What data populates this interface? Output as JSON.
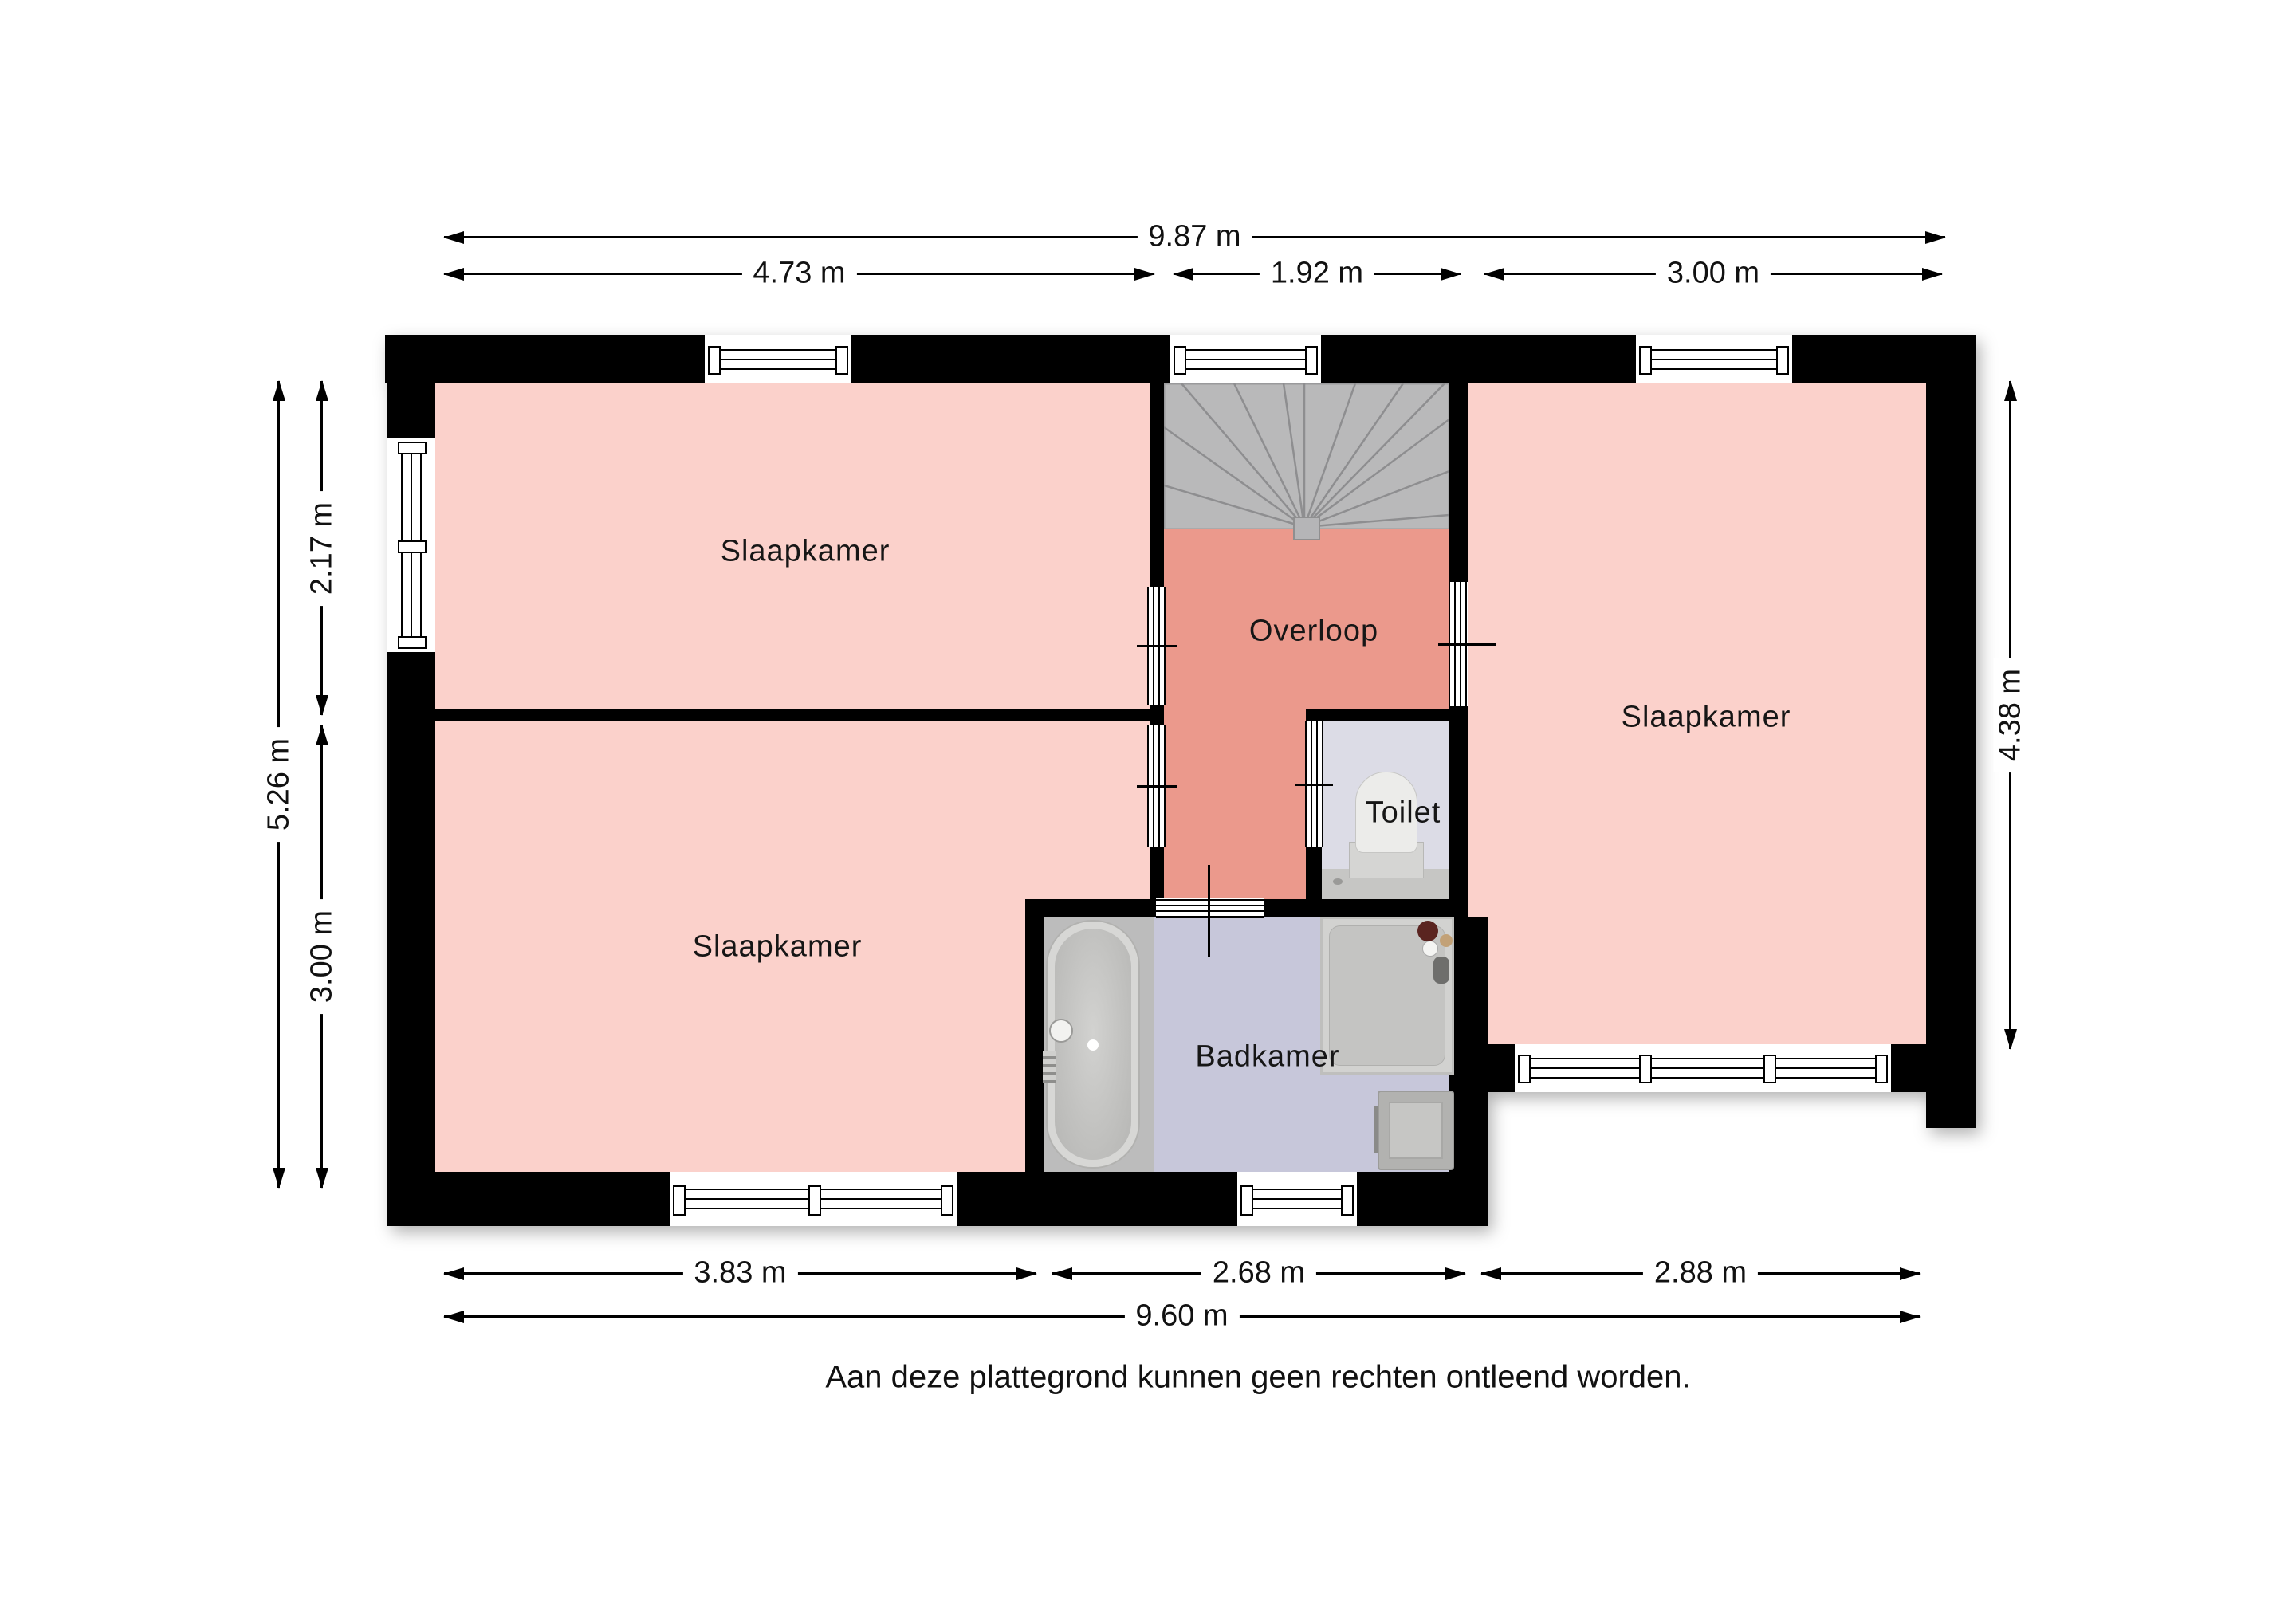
{
  "rooms": {
    "bedroom_top_left": {
      "label": "Slaapkamer"
    },
    "bedroom_bottom_left": {
      "label": "Slaapkamer"
    },
    "bedroom_right": {
      "label": "Slaapkamer"
    },
    "landing": {
      "label": "Overloop"
    },
    "toilet": {
      "label": "Toilet"
    },
    "bathroom": {
      "label": "Badkamer"
    }
  },
  "dimensions": {
    "top_total": "9.87 m",
    "top_left": "4.73 m",
    "top_middle": "1.92 m",
    "top_right": "3.00 m",
    "left_total": "5.26 m",
    "left_upper": "2.17 m",
    "left_lower": "3.00 m",
    "right_side": "4.38 m",
    "bottom_left": "3.83 m",
    "bottom_middle": "2.68 m",
    "bottom_right": "2.88 m",
    "bottom_total": "9.60 m"
  },
  "footer": {
    "disclaimer": "Aan deze plattegrond kunnen geen rechten ontleend worden."
  },
  "colors": {
    "wall": "#000000",
    "bedroom_pink": "#fbd1cb",
    "landing_salmon": "#eb998c",
    "bathroom_floor": "#c7c7da",
    "toilet_floor": "#dcdce6",
    "stairs_gray": "#b9b9ba",
    "tub_platform": "#bcbcbc",
    "shower_gray": "#c4c4c2"
  }
}
